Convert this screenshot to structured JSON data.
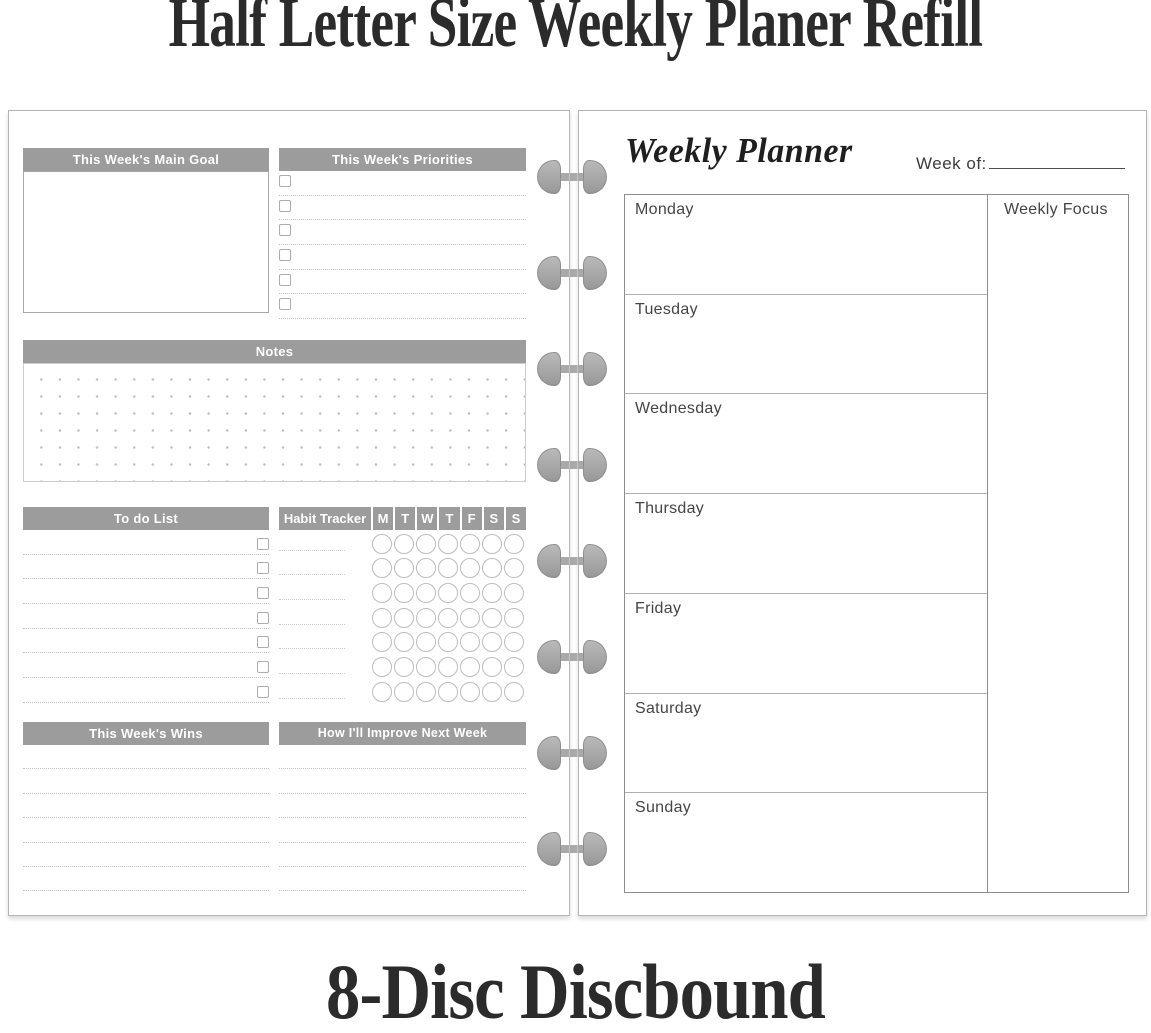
{
  "titles": {
    "top": "Half Letter Size Weekly Planer Refill",
    "bottom": "8-Disc Discbound"
  },
  "left_page": {
    "main_goal_header": "This Week's Main Goal",
    "priorities_header": "This Week's Priorities",
    "priorities_rows": 6,
    "notes_header": "Notes",
    "todo_header": "To do List",
    "todo_rows": 7,
    "habit_tracker": {
      "header": "Habit Tracker",
      "days": [
        "M",
        "T",
        "W",
        "T",
        "F",
        "S",
        "S"
      ],
      "rows": 7,
      "circles_per_row": 7
    },
    "wins_header": "This Week's Wins",
    "improve_header": "How I'll Improve Next Week",
    "lines_per_bottom_section": 6
  },
  "right_page": {
    "title": "Weekly Planner",
    "week_of_label": "Week of:",
    "days": [
      "Monday",
      "Tuesday",
      "Wednesday",
      "Thursday",
      "Friday",
      "Saturday",
      "Sunday"
    ],
    "focus_header": "Weekly Focus"
  },
  "binding": {
    "disc_count": 8
  },
  "colors": {
    "header_bar": "#9c9c9c",
    "header_text": "#ffffff",
    "disc": "#a9a9a9",
    "page_border": "#b5b5b5",
    "table_border": "#8d8d8d",
    "day_text": "#454545",
    "title_text": "#2b2b2b"
  }
}
